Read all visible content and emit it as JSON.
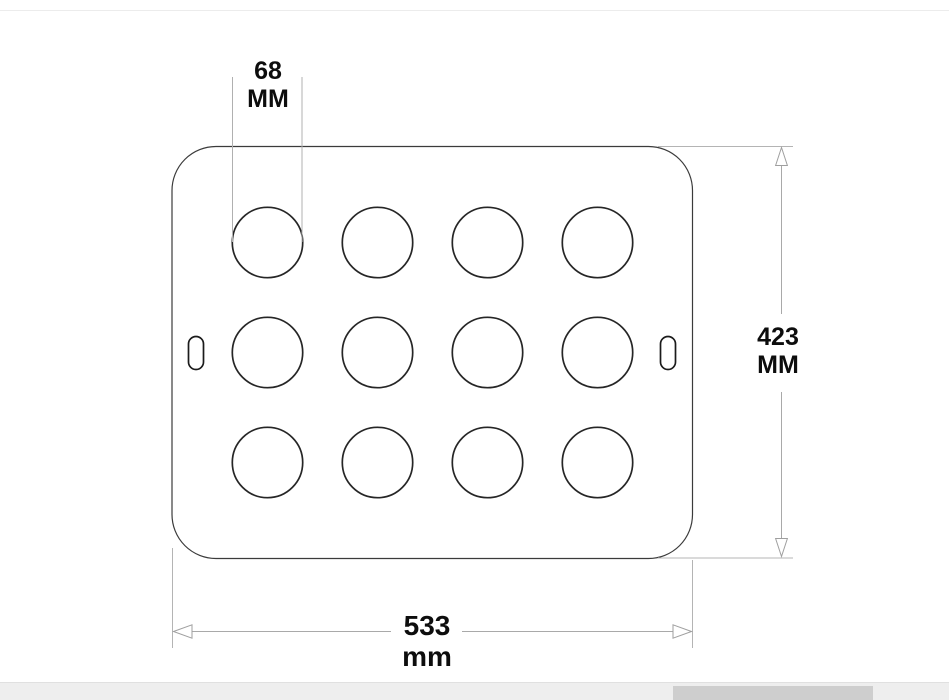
{
  "drawing": {
    "dimensions": {
      "hole_diameter": {
        "value": "68",
        "unit": "MM"
      },
      "plate_height": {
        "value": "423",
        "unit": "MM"
      },
      "plate_width": {
        "value": "533",
        "unit": "mm"
      }
    },
    "holes": {
      "rows": 3,
      "cols": 4,
      "count": 12,
      "row_centers_px": [
        242.5,
        352.5,
        462.5
      ],
      "col_centers_px": [
        267.5,
        377.5,
        487.5,
        597.5
      ],
      "radius_px": 35.2
    },
    "colors": {
      "outline": "#3b3b3b",
      "hole_stroke": "#262626",
      "dimension_line": "#a9a9a9",
      "label_text": "#0d0d0d",
      "scrollbar_track": "#eeeeee",
      "scrollbar_thumb": "#cecece"
    }
  }
}
